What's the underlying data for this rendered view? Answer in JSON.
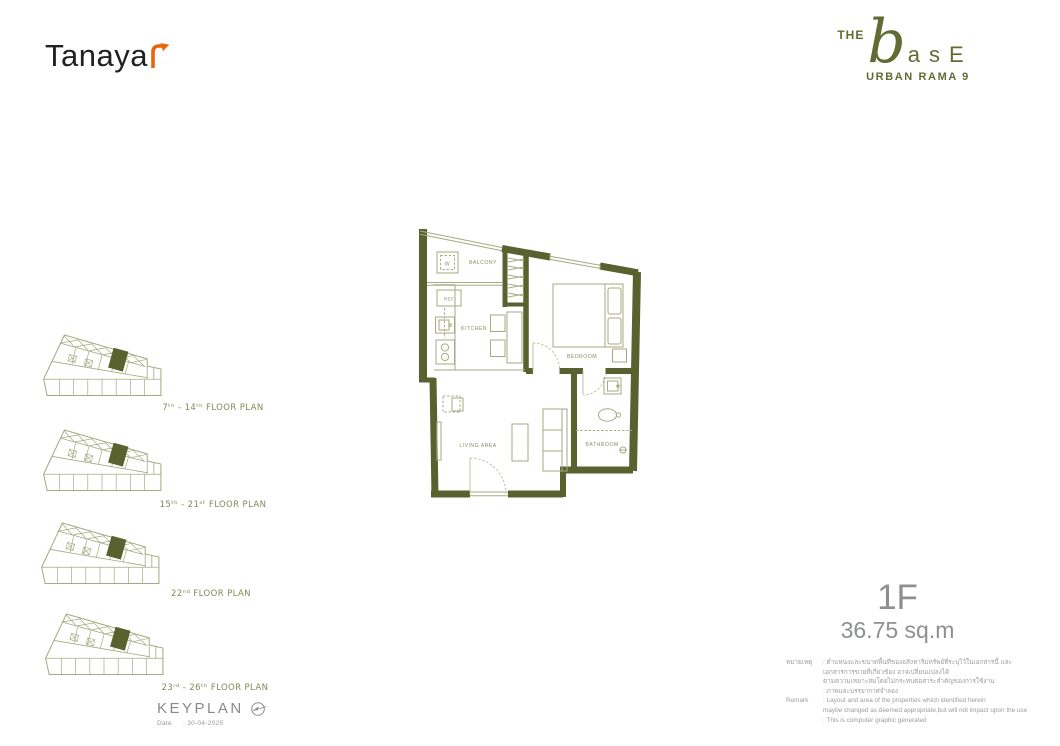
{
  "colors": {
    "wall_green": "#59612e",
    "furniture_olive": "#a6aa80",
    "plan_label_olive": "#8c9060",
    "logo_green": "#5f6d33",
    "accent_orange": "#e8650f",
    "brand_dark": "#232020",
    "unit_gray": "#8e8f90",
    "remark_gray": "#9c9c9c"
  },
  "header": {
    "tanayar_text": "Tanaya",
    "the": "THE",
    "base_initial": "b",
    "base_rest": "asE",
    "subtitle": "URBAN RAMA 9"
  },
  "keyplan": {
    "title": "KEYPLAN",
    "date_label": "Date",
    "date_value": ": 30-04-2025",
    "plans": [
      {
        "label": "7ᵗʰ - 14ᵗʰ FLOOR PLAN"
      },
      {
        "label": "15ᵗʰ - 21ˢᵗ FLOOR PLAN"
      },
      {
        "label": "22ⁿᵈ FLOOR PLAN"
      },
      {
        "label": "23ʳᵈ - 26ᵗʰ FLOOR PLAN"
      }
    ]
  },
  "unit": {
    "type": "1F",
    "area": "36.75 sq.m"
  },
  "plan": {
    "labels": {
      "washer": "W",
      "balcony": "BALCONY",
      "ref": "REF",
      "kitchen": "KITCHEN",
      "bedroom": "BEDROOM",
      "living_area": "LIVING AREA",
      "bathroom": "BATHROOM"
    }
  },
  "remarks": {
    "th_label": "หมายเหตุ",
    "th_line1": ": ตำแหน่งและขนาดพื้นที่ของอสังหาริมทรัพย์ที่ระบุไว้ในเอกสารนี้ และเอกสารการขายที่เกี่ยวข้อง อาจเปลี่ยนแปลงได้",
    "th_line2": "ตามความเหมาะสมโดยไม่กระทบต่อสาระสำคัญของการใช้งาน",
    "th_line3": ": ภาพและบรรยากาศจำลอง",
    "en_label": "Remark",
    "en_line1": ": Layout and area of the properties which identified herein",
    "en_line2": "maybe changed as deemed appropriate,but will not impact upon the use",
    "en_line3": ": This is computer graphic generated"
  }
}
